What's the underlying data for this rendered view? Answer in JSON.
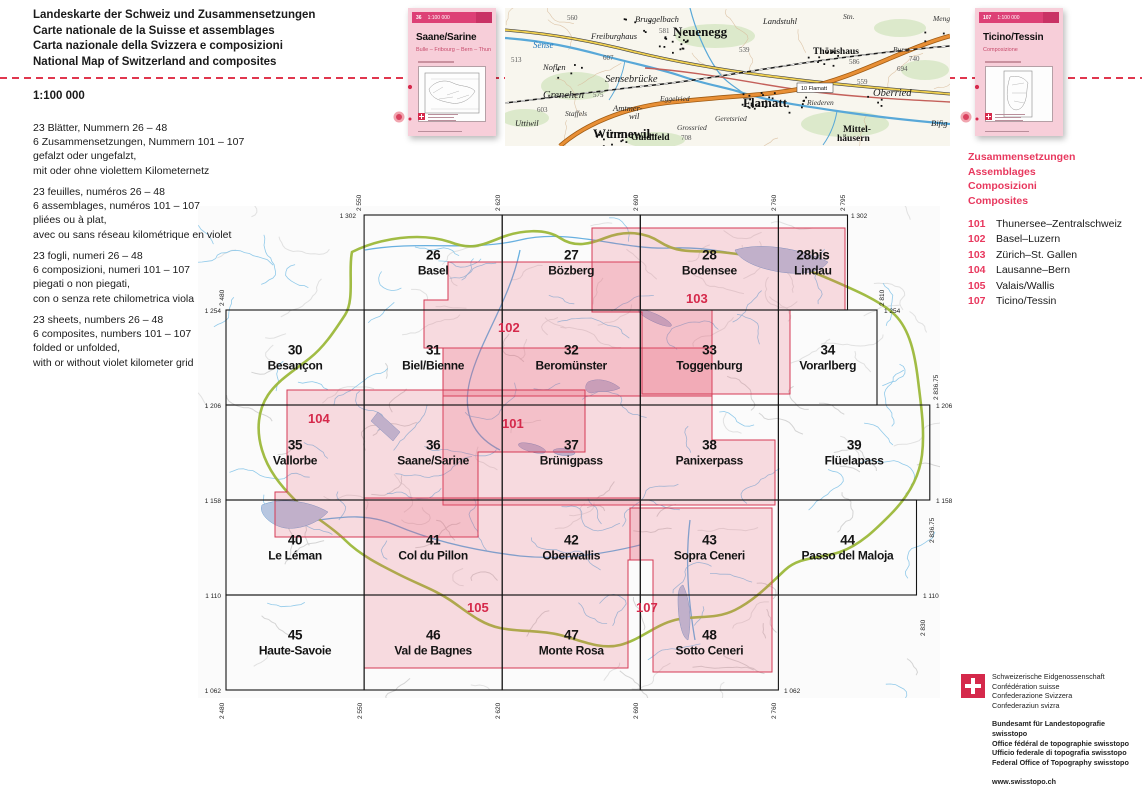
{
  "page": {
    "title_lines": [
      "Landeskarte der Schweiz und Zusammensetzungen",
      "Carte nationale de la Suisse et assemblages",
      "Carta nazionale della Svizzera e composizioni",
      "National Map of Switzerland and composites"
    ],
    "scale_label": "1:100 000"
  },
  "descriptions": [
    {
      "lang": "de",
      "lines": [
        "23 Blätter, Nummern 26 – 48",
        "6 Zusammensetzungen, Nummern 101 – 107",
        "gefalzt oder ungefalzt,",
        "mit oder ohne violettem Kilometernetz"
      ]
    },
    {
      "lang": "fr",
      "lines": [
        "23 feuilles, numéros 26 – 48",
        "6 assemblages, numéros 101 – 107",
        "pliées ou à plat,",
        "avec ou sans réseau kilométrique en violet"
      ]
    },
    {
      "lang": "it",
      "lines": [
        "23 fogli, numeri 26 – 48",
        "6 composizioni, numeri 101 – 107",
        "piegati o non piegati,",
        "con o senza rete chilometrica viola"
      ]
    },
    {
      "lang": "en",
      "lines": [
        "23 sheets, numbers 26 – 48",
        "6 composites, numbers 101 – 107",
        "folded or unfolded,",
        "with or without violet kilometer grid"
      ]
    }
  ],
  "covers": [
    {
      "number": "36",
      "scale": "1:100 000",
      "title": "Saane/Sarine",
      "subtitle": "Bulle – Fribourg – Bern – Thun"
    },
    {
      "number": "107",
      "scale": "1:100 000",
      "title": "Ticino/Tessin",
      "subtitle": "Composizione"
    }
  ],
  "composites_panel": {
    "headings": [
      "Zusammensetzungen",
      "Assemblages",
      "Composizioni",
      "Composites"
    ],
    "items": [
      {
        "number": "101",
        "name": "Thunersee–Zentralschweiz"
      },
      {
        "number": "102",
        "name": "Basel–Luzern"
      },
      {
        "number": "103",
        "name": "Zürich–St. Gallen"
      },
      {
        "number": "104",
        "name": "Lausanne–Bern"
      },
      {
        "number": "105",
        "name": "Valais/Wallis"
      },
      {
        "number": "107",
        "name": "Ticino/Tessin"
      }
    ]
  },
  "index_map": {
    "sheets": [
      {
        "no": "26",
        "name": "Basel",
        "e": [
          2550,
          2620
        ],
        "n": [
          1254,
          1302
        ]
      },
      {
        "no": "27",
        "name": "Bözberg",
        "e": [
          2620,
          2690
        ],
        "n": [
          1254,
          1302
        ]
      },
      {
        "no": "28",
        "name": "Bodensee",
        "e": [
          2690,
          2760
        ],
        "n": [
          1254,
          1302
        ]
      },
      {
        "no": "28bis",
        "name": "Lindau",
        "e": [
          2760,
          2795
        ],
        "n": [
          1254,
          1302
        ]
      },
      {
        "no": "30",
        "name": "Besançon",
        "e": [
          2480,
          2550
        ],
        "n": [
          1206,
          1254
        ]
      },
      {
        "no": "31",
        "name": "Biel/Bienne",
        "e": [
          2550,
          2620
        ],
        "n": [
          1206,
          1254
        ]
      },
      {
        "no": "32",
        "name": "Beromünster",
        "e": [
          2620,
          2690
        ],
        "n": [
          1206,
          1254
        ]
      },
      {
        "no": "33",
        "name": "Toggenburg",
        "e": [
          2690,
          2760
        ],
        "n": [
          1206,
          1254
        ]
      },
      {
        "no": "34",
        "name": "Vorarlberg",
        "e": [
          2760,
          2810
        ],
        "n": [
          1206,
          1254
        ]
      },
      {
        "no": "35",
        "name": "Vallorbe",
        "e": [
          2480,
          2550
        ],
        "n": [
          1158,
          1206
        ]
      },
      {
        "no": "36",
        "name": "Saane/Sarine",
        "e": [
          2550,
          2620
        ],
        "n": [
          1158,
          1206
        ]
      },
      {
        "no": "37",
        "name": "Brünigpass",
        "e": [
          2620,
          2690
        ],
        "n": [
          1158,
          1206
        ]
      },
      {
        "no": "38",
        "name": "Panixerpass",
        "e": [
          2690,
          2760
        ],
        "n": [
          1158,
          1206
        ]
      },
      {
        "no": "39",
        "name": "Flüelapass",
        "e": [
          2760,
          2836.75
        ],
        "n": [
          1158,
          1206
        ]
      },
      {
        "no": "40",
        "name": "Le Léman",
        "e": [
          2480,
          2550
        ],
        "n": [
          1110,
          1158
        ]
      },
      {
        "no": "41",
        "name": "Col du Pillon",
        "e": [
          2550,
          2620
        ],
        "n": [
          1110,
          1158
        ]
      },
      {
        "no": "42",
        "name": "Oberwallis",
        "e": [
          2620,
          2690
        ],
        "n": [
          1110,
          1158
        ]
      },
      {
        "no": "43",
        "name": "Sopra Ceneri",
        "e": [
          2690,
          2760
        ],
        "n": [
          1110,
          1158
        ]
      },
      {
        "no": "44",
        "name": "Passo del Maloja",
        "e": [
          2760,
          2830
        ],
        "n": [
          1110,
          1158
        ]
      },
      {
        "no": "45",
        "name": "Haute-Savoie",
        "e": [
          2480,
          2550
        ],
        "n": [
          1062,
          1110
        ]
      },
      {
        "no": "46",
        "name": "Val de Bagnes",
        "e": [
          2550,
          2620
        ],
        "n": [
          1062,
          1110
        ]
      },
      {
        "no": "47",
        "name": "Monte Rosa",
        "e": [
          2620,
          2690
        ],
        "n": [
          1062,
          1110
        ]
      },
      {
        "no": "48",
        "name": "Sotto Ceneri",
        "e": [
          2690,
          2760
        ],
        "n": [
          1062,
          1110
        ]
      }
    ],
    "composites": [
      {
        "number": "101",
        "x": 502,
        "y": 428
      },
      {
        "number": "102",
        "x": 498,
        "y": 332
      },
      {
        "number": "103",
        "x": 686,
        "y": 303
      },
      {
        "number": "104",
        "x": 308,
        "y": 423
      },
      {
        "number": "105",
        "x": 467,
        "y": 612
      },
      {
        "number": "107",
        "x": 636,
        "y": 612
      }
    ],
    "edge_labels": [
      {
        "text": "1 302",
        "x": 356,
        "y": 218,
        "anchor": "end",
        "rot": false
      },
      {
        "text": "1 254",
        "x": 221,
        "y": 313,
        "anchor": "end",
        "rot": false
      },
      {
        "text": "1 206",
        "x": 221,
        "y": 408,
        "anchor": "end",
        "rot": false
      },
      {
        "text": "1 158",
        "x": 221,
        "y": 503,
        "anchor": "end",
        "rot": false
      },
      {
        "text": "1 110",
        "x": 221,
        "y": 598,
        "anchor": "end",
        "rot": false
      },
      {
        "text": "1 062",
        "x": 221,
        "y": 693,
        "anchor": "end",
        "rot": false
      },
      {
        "text": "1 302",
        "x": 851,
        "y": 218,
        "anchor": "start",
        "rot": false
      },
      {
        "text": "1 254",
        "x": 884,
        "y": 313,
        "anchor": "start",
        "rot": false
      },
      {
        "text": "1 206",
        "x": 936,
        "y": 408,
        "anchor": "start",
        "rot": false
      },
      {
        "text": "1 158",
        "x": 936,
        "y": 503,
        "anchor": "start",
        "rot": false
      },
      {
        "text": "1 110",
        "x": 923,
        "y": 598,
        "anchor": "start",
        "rot": false
      },
      {
        "text": "1 062",
        "x": 784,
        "y": 693,
        "anchor": "start",
        "rot": false
      },
      {
        "text": "2 550",
        "x": 361,
        "y": 211,
        "anchor": "start",
        "rot": true
      },
      {
        "text": "2 620",
        "x": 500,
        "y": 211,
        "anchor": "start",
        "rot": true
      },
      {
        "text": "2 690",
        "x": 638,
        "y": 211,
        "anchor": "start",
        "rot": true
      },
      {
        "text": "2 760",
        "x": 776,
        "y": 211,
        "anchor": "start",
        "rot": true
      },
      {
        "text": "2 795",
        "x": 845,
        "y": 211,
        "anchor": "start",
        "rot": true
      },
      {
        "text": "2 480",
        "x": 224,
        "y": 306,
        "anchor": "start",
        "rot": true
      },
      {
        "text": "2 810",
        "x": 884,
        "y": 306,
        "anchor": "start",
        "rot": true
      },
      {
        "text": "2 836.75",
        "x": 938,
        "y": 400,
        "anchor": "start",
        "rot": true
      },
      {
        "text": "2 836.75",
        "x": 934,
        "y": 543,
        "anchor": "start",
        "rot": true
      },
      {
        "text": "2 830",
        "x": 925,
        "y": 636,
        "anchor": "start",
        "rot": true
      },
      {
        "text": "2 480",
        "x": 224,
        "y": 719,
        "anchor": "start",
        "rot": true
      },
      {
        "text": "2 550",
        "x": 362,
        "y": 719,
        "anchor": "start",
        "rot": true
      },
      {
        "text": "2 620",
        "x": 500,
        "y": 719,
        "anchor": "start",
        "rot": true
      },
      {
        "text": "2 690",
        "x": 638,
        "y": 719,
        "anchor": "start",
        "rot": true
      },
      {
        "text": "2 760",
        "x": 776,
        "y": 719,
        "anchor": "start",
        "rot": true
      }
    ]
  },
  "map_sample": {
    "labels": [
      {
        "t": "Bruggelbach",
        "x": 130,
        "y": 14,
        "c": "s-ham"
      },
      {
        "t": "Landstuhl",
        "x": 258,
        "y": 16,
        "c": "s-ham"
      },
      {
        "t": "Stn.",
        "x": 338,
        "y": 11,
        "c": "s-ham-s"
      },
      {
        "t": "Thörishaus",
        "x": 308,
        "y": 46,
        "c": "s-town-m"
      },
      {
        "t": "Neuenegg",
        "x": 168,
        "y": 28,
        "c": "s-town-l"
      },
      {
        "t": "Freiburghaus",
        "x": 86,
        "y": 31,
        "c": "s-ham"
      },
      {
        "t": "581",
        "x": 154,
        "y": 25,
        "c": "s-num"
      },
      {
        "t": "560",
        "x": 62,
        "y": 12,
        "c": "s-num"
      },
      {
        "t": "Sense",
        "x": 28,
        "y": 40,
        "c": "s-riv"
      },
      {
        "t": "607",
        "x": 98,
        "y": 52,
        "c": "s-num"
      },
      {
        "t": "Noflen",
        "x": 38,
        "y": 62,
        "c": "s-ham"
      },
      {
        "t": "513",
        "x": 6,
        "y": 54,
        "c": "s-num"
      },
      {
        "t": "Grenchen",
        "x": 38,
        "y": 90,
        "c": "s-ham-l"
      },
      {
        "t": "575",
        "x": 88,
        "y": 89,
        "c": "s-num"
      },
      {
        "t": "603",
        "x": 32,
        "y": 104,
        "c": "s-num"
      },
      {
        "t": "Staffels",
        "x": 60,
        "y": 108,
        "c": "s-ham-s"
      },
      {
        "t": "Amtmer-",
        "x": 108,
        "y": 103,
        "c": "s-ham"
      },
      {
        "t": "wil",
        "x": 124,
        "y": 111,
        "c": "s-ham"
      },
      {
        "t": "Uttiwil",
        "x": 10,
        "y": 118,
        "c": "s-ham"
      },
      {
        "t": "Wünnewil-",
        "x": 88,
        "y": 130,
        "c": "s-town-l"
      },
      {
        "t": "Sensebrücke",
        "x": 100,
        "y": 74,
        "c": "s-ham-l"
      },
      {
        "t": "Eggelried",
        "x": 155,
        "y": 93,
        "c": "s-ham-s"
      },
      {
        "t": "Flamatt",
        "x": 238,
        "y": 99,
        "c": "s-town-l"
      },
      {
        "t": "Riederen",
        "x": 302,
        "y": 97,
        "c": "s-ham-s"
      },
      {
        "t": "539",
        "x": 234,
        "y": 44,
        "c": "s-num"
      },
      {
        "t": "Geretsried",
        "x": 210,
        "y": 113,
        "c": "s-ham-s"
      },
      {
        "t": "Grossried",
        "x": 172,
        "y": 122,
        "c": "s-ham-s"
      },
      {
        "t": "Guldifeld",
        "x": 126,
        "y": 132,
        "c": "s-town-m"
      },
      {
        "t": "708",
        "x": 176,
        "y": 132,
        "c": "s-num"
      },
      {
        "t": "Mittel-",
        "x": 338,
        "y": 124,
        "c": "s-town-m"
      },
      {
        "t": "häusern",
        "x": 332,
        "y": 133,
        "c": "s-town-m"
      },
      {
        "t": "Oberried",
        "x": 368,
        "y": 88,
        "c": "s-ham-l"
      },
      {
        "t": "586",
        "x": 344,
        "y": 56,
        "c": "s-num"
      },
      {
        "t": "559",
        "x": 352,
        "y": 76,
        "c": "s-num"
      },
      {
        "t": "Burst",
        "x": 388,
        "y": 44,
        "c": "s-ham-s"
      },
      {
        "t": "740",
        "x": 404,
        "y": 53,
        "c": "s-num"
      },
      {
        "t": "694",
        "x": 392,
        "y": 63,
        "c": "s-num"
      },
      {
        "t": "Bifig",
        "x": 426,
        "y": 118,
        "c": "s-ham"
      },
      {
        "t": "Meng-",
        "x": 428,
        "y": 13,
        "c": "s-ham-s"
      },
      {
        "t": "10 Flamatt",
        "x": 296,
        "y": 82,
        "c": "s-exit"
      }
    ]
  },
  "footer": {
    "confederation_lines": [
      "Schweizerische Eidgenossenschaft",
      "Confédération suisse",
      "Confederazione Svizzera",
      "Confederaziun svizra"
    ],
    "office_lines": [
      "Bundesamt für Landestopografie swisstopo",
      "Office fédéral de topographie swisstopo",
      "Ufficio federale di topografia swisstopo",
      "Federal Office of Topography swisstopo"
    ],
    "website": "www.swisstopo.ch"
  }
}
